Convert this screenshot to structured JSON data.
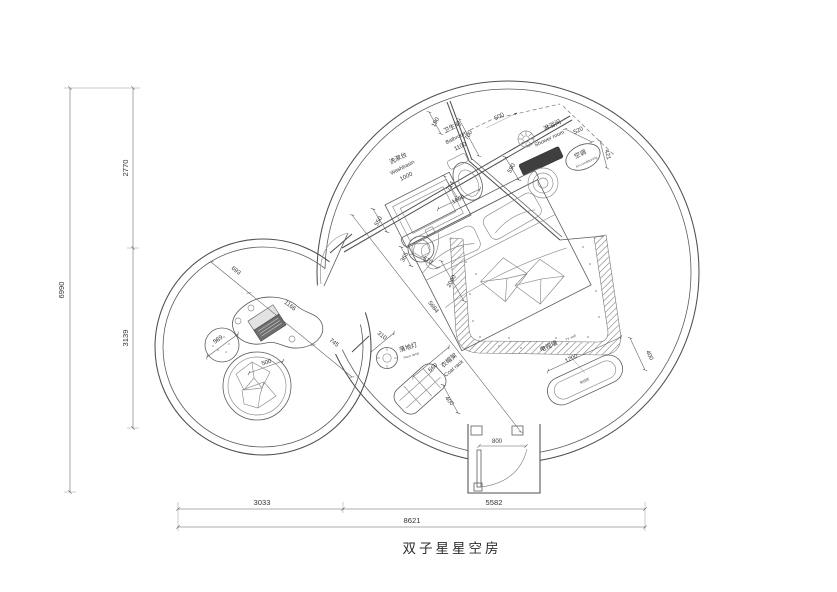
{
  "title": "双子星星空房",
  "rooms": {
    "washbasin": {
      "cn": "洗漱台",
      "en": "Washbasin",
      "size": "1000"
    },
    "bathroom": {
      "cn": "卫生间",
      "en": "Bathroom",
      "size": "1100"
    },
    "shower": {
      "cn": "淋浴间",
      "en": "Shower room"
    },
    "ac": {
      "cn": "空调",
      "en": "Air-conditioning"
    },
    "tv_wall": {
      "cn": "电视墙",
      "en": "TV wall",
      "cabinet": "电视柜"
    },
    "floor_lamp": {
      "cn": "落地灯",
      "en": "Floor lamp"
    },
    "coat_rack": {
      "cn": "衣帽架",
      "en": "Coat rack"
    }
  },
  "dims": {
    "left_top": "2770",
    "left_bottom": "3139",
    "left_total": "6990",
    "bottom_left": "3033",
    "bottom_right": "5582",
    "bottom_total": "8621",
    "bath_offset": "190",
    "bath_depth": "700",
    "shower_width": "500",
    "shower_depth": "520",
    "ac_depth": "421",
    "counter_depth": "550",
    "toilet_width": "714",
    "bed_width": "1800",
    "shower_gap": "590",
    "bed_length": "2000",
    "room_diagonal": "5684",
    "sink_a": "365",
    "sink_b": "570",
    "tv_length": "1200",
    "tv_depth": "400",
    "lamp": "310",
    "rack_length": "660",
    "rack_depth": "400",
    "door": "800",
    "lounge_a": "693",
    "lounge_table": "1166",
    "lounge_b": "745",
    "ottoman": "589",
    "chair": "500"
  }
}
